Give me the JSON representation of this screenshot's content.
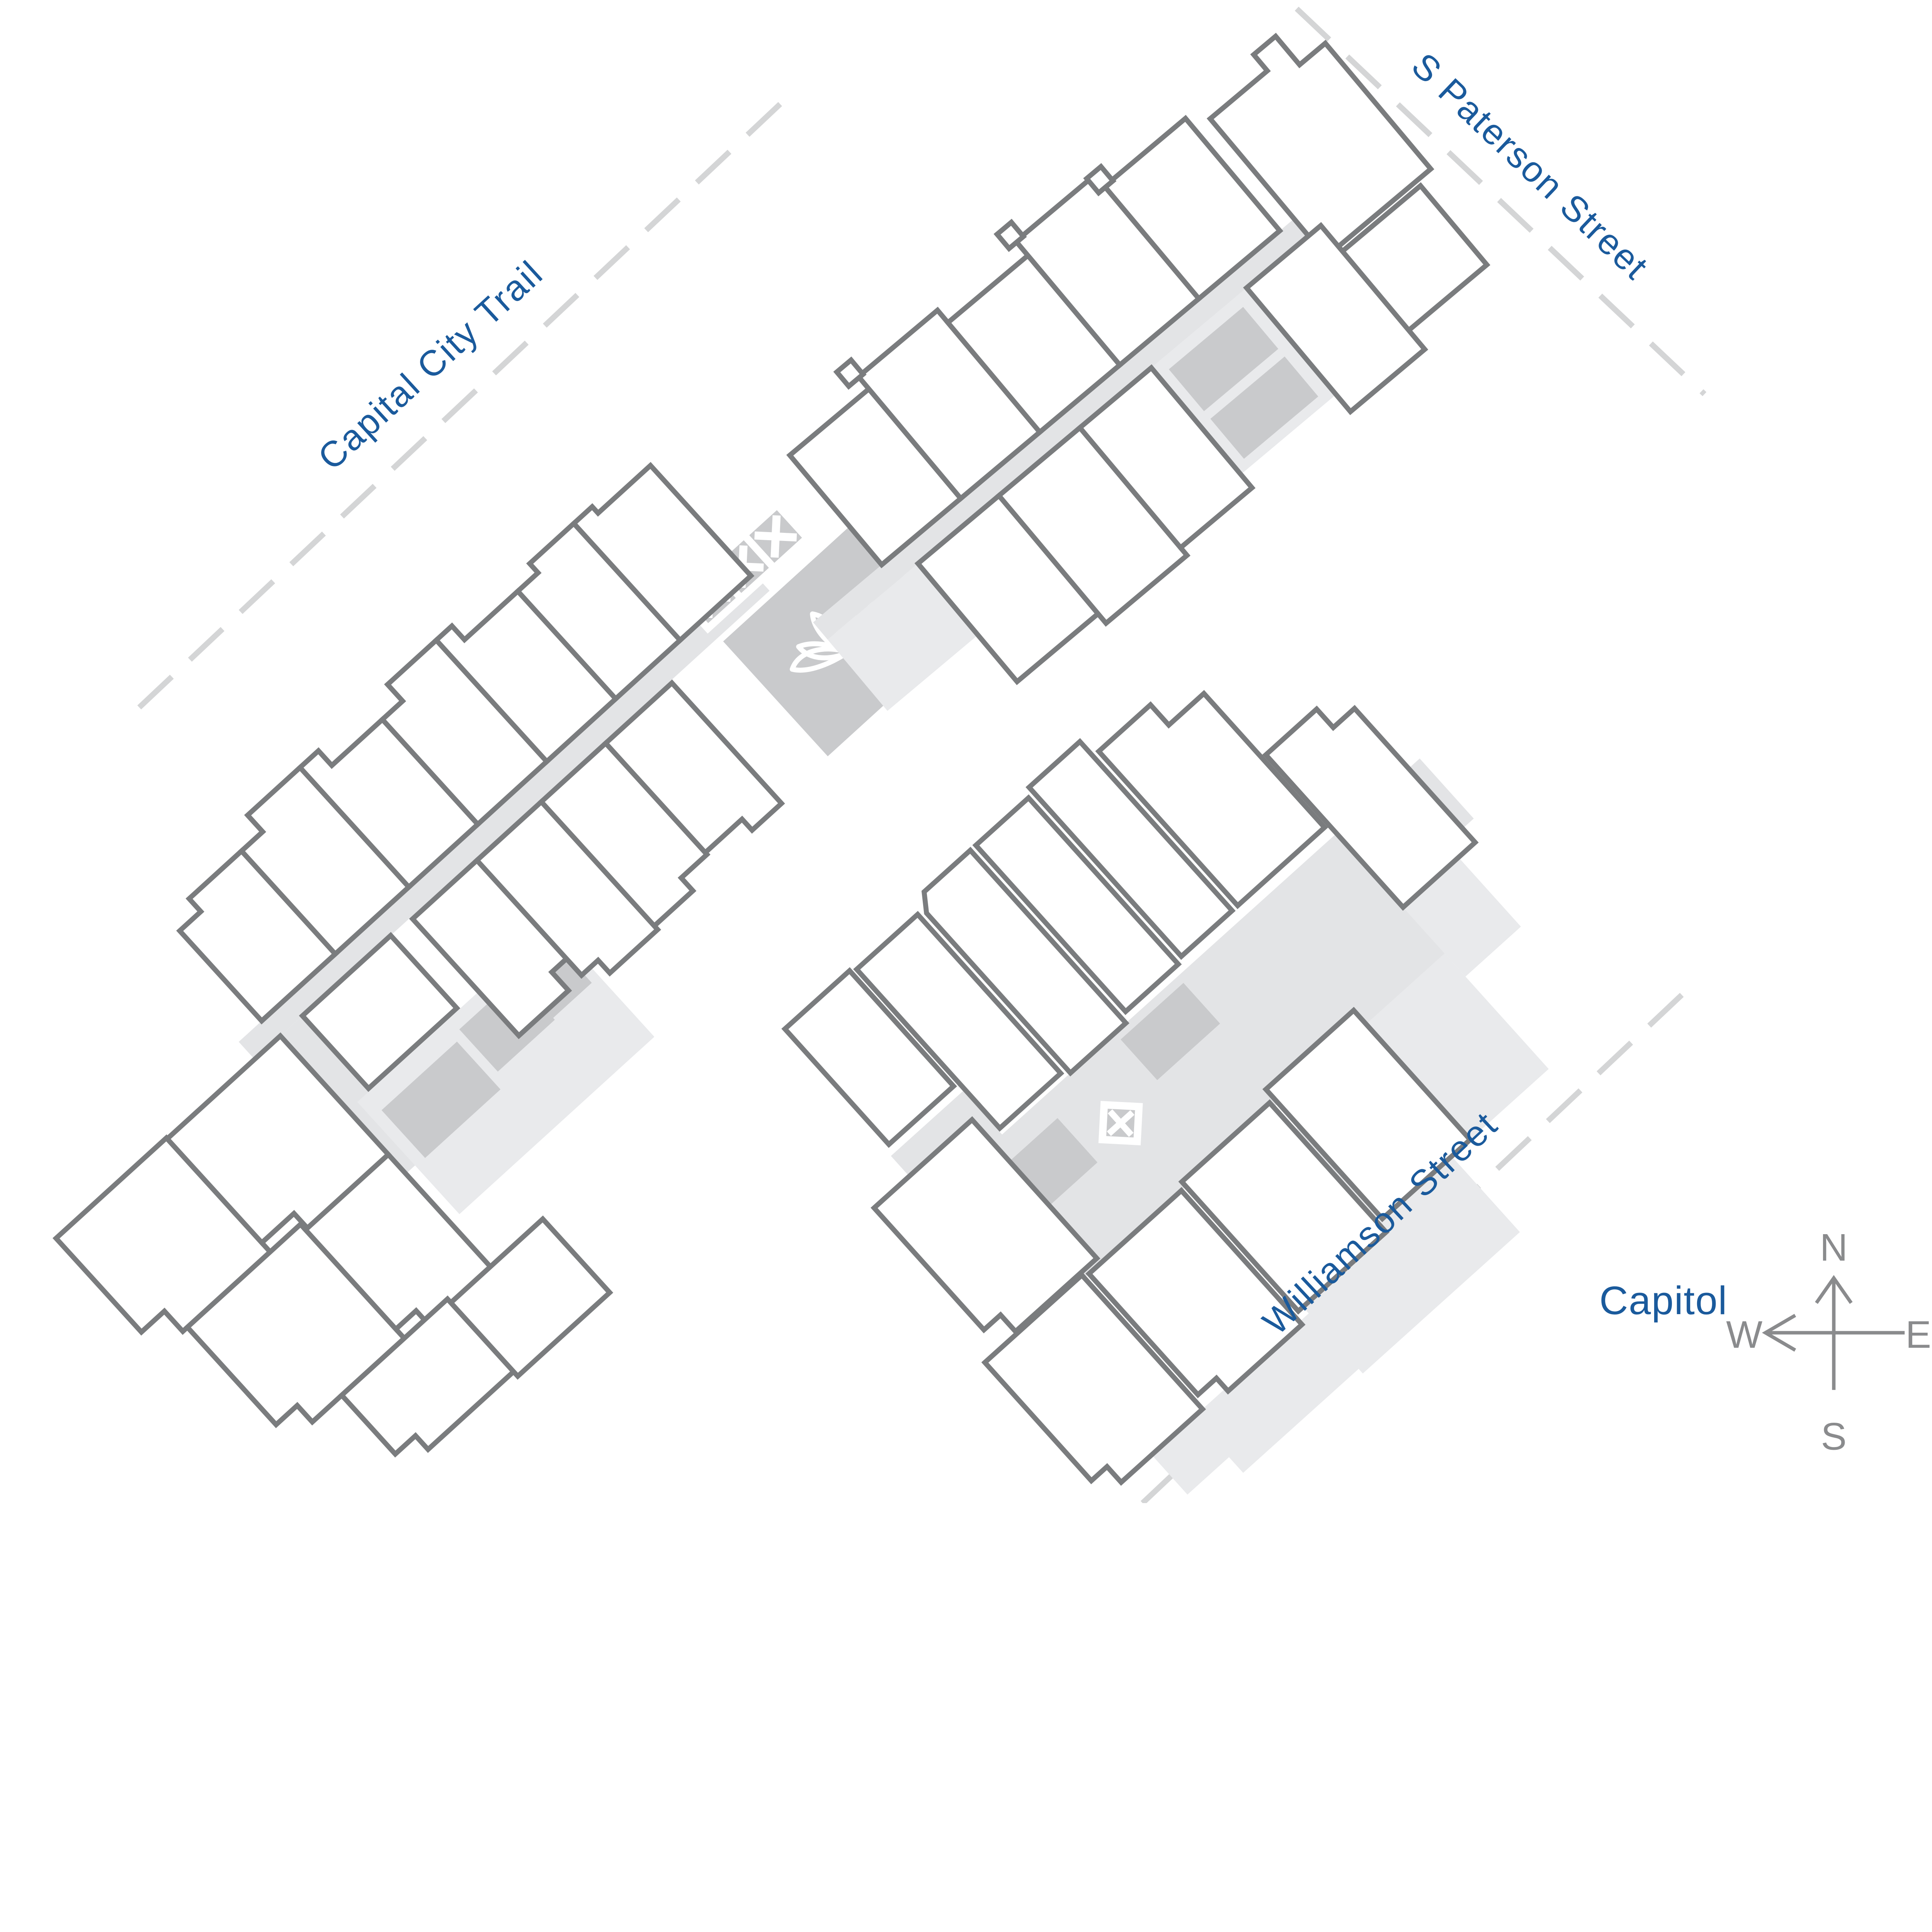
{
  "map": {
    "streets": [
      {
        "id": "capital-city-trail",
        "label": "Capital City Trail"
      },
      {
        "id": "s-paterson-street",
        "label": "S Paterson Street"
      },
      {
        "id": "williamson-street",
        "label": "Williamson Street"
      }
    ],
    "landmarks": [
      {
        "id": "capitol",
        "label": "Capitol"
      }
    ],
    "compass": {
      "north": "N",
      "east": "E",
      "south": "S",
      "west": "W"
    },
    "icons": [
      {
        "id": "lotus-icon"
      },
      {
        "id": "stair-cross-icon"
      },
      {
        "id": "compass-rose-icon"
      }
    ],
    "highlighted_unit": {
      "building": "south-east-building"
    },
    "colors": {
      "highlight_blue": "#1160a5",
      "label_blue": "#1a5a9c",
      "unit_outline_gray": "#7a7c7e",
      "corridor_gray": "#e3e4e6",
      "terrace_gray": "#e9eaec",
      "utility_gray": "#c9cacc",
      "street_dash_gray": "#d4d5d6",
      "compass_gray": "#8a8b8d",
      "background": "#ffffff"
    }
  }
}
